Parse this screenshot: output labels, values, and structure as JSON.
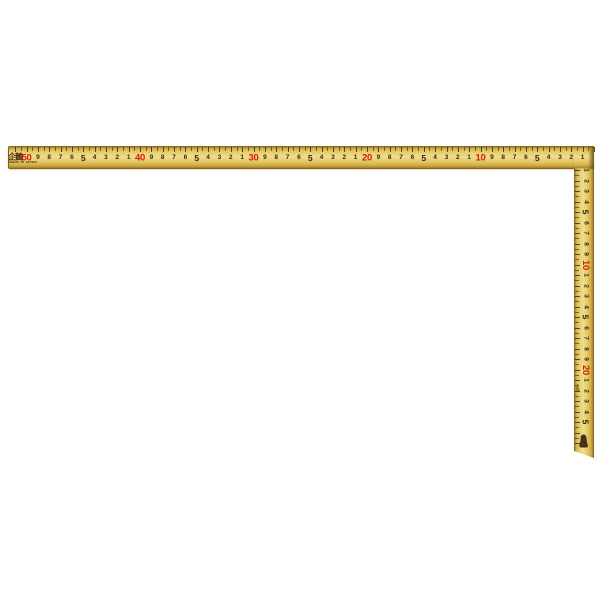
{
  "square": {
    "brand": "企鵝",
    "origin_text": "MADE IN JAPAN",
    "side_brand": "企鵝",
    "colors": {
      "body_gold": "#e3c766",
      "body_highlight": "#f0dc8a",
      "edge_dark": "#6e5316",
      "tens_red": "#d42100",
      "digits_black": "#33281a"
    },
    "horizontal_scale": {
      "red_tens_left_to_right": [
        "50",
        "40",
        "30",
        "20",
        "10"
      ],
      "labels_from_corner": [
        "1",
        "2",
        "3",
        "4",
        "5",
        "6",
        "7",
        "8",
        "9",
        "10",
        "1",
        "2",
        "3",
        "4",
        "5",
        "6",
        "7",
        "8",
        "9",
        "20",
        "1",
        "2",
        "3",
        "4",
        "5",
        "6",
        "7",
        "8",
        "9",
        "30",
        "1",
        "2",
        "3",
        "4",
        "5",
        "6",
        "7",
        "8",
        "9",
        "40",
        "1",
        "2",
        "3",
        "4",
        "5",
        "6",
        "7",
        "8",
        "9",
        "50"
      ]
    },
    "vertical_scale": {
      "red_tens_top_to_bottom": [
        "10",
        "20"
      ],
      "labels_from_corner": [
        "1",
        "2",
        "3",
        "4",
        "5",
        "6",
        "7",
        "8",
        "9",
        "10",
        "1",
        "2",
        "3",
        "4",
        "5",
        "6",
        "7",
        "8",
        "9",
        "20",
        "1",
        "2",
        "3",
        "4",
        "5"
      ]
    }
  }
}
